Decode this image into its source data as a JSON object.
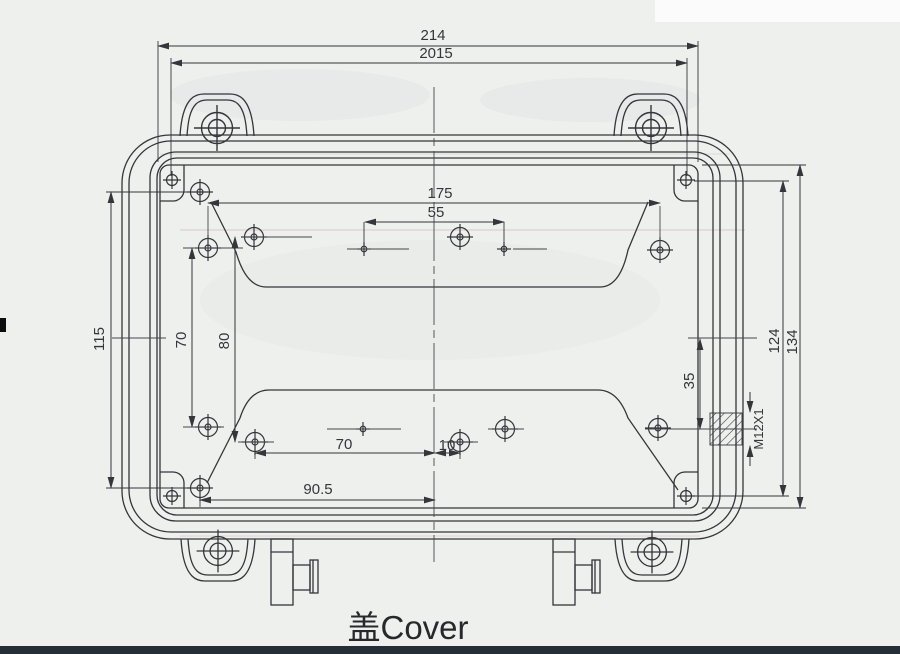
{
  "title": {
    "text": "盖Cover"
  },
  "dimensions": {
    "top_outer": "214",
    "top_inner": "2015",
    "holes_span": "175",
    "center_pair": "55",
    "left_height": "115",
    "left_col": "70",
    "left_col2": "80",
    "right_holes": "124",
    "right_inner": "134",
    "gland_offset": "35",
    "thread": "M12X1",
    "bottom_left": "70",
    "bottom_mid": "10",
    "bottom_span": "90.5"
  }
}
